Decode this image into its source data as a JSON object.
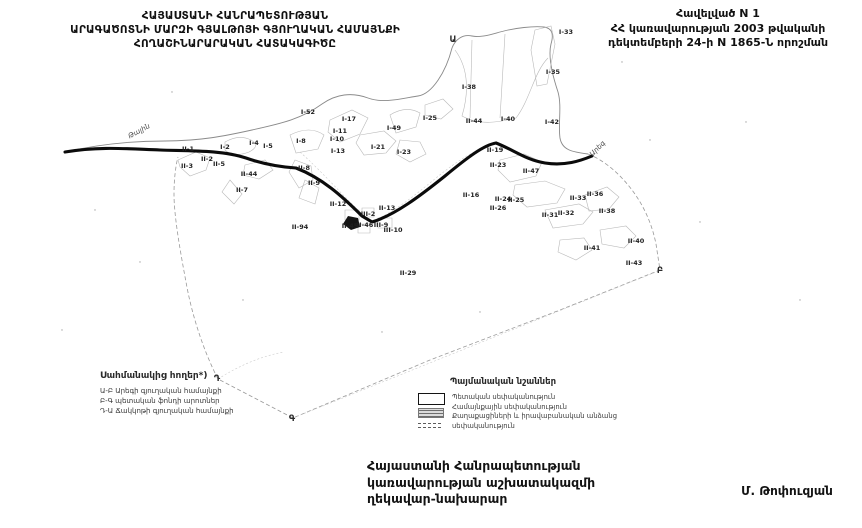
{
  "header": {
    "title_left": [
      "ՀԱՅԱՍՏԱՆԻ ՀԱՆՐԱՊԵՏՈՒԹՅԱՆ",
      "ԱՐԱԳԱԾՈՏՆԻ ՄԱՐԶԻ ԳՅԱԼԹՈՅԻ ԳՅՈՒՂԱԿԱՆ ՀԱՄԱՅՆՔԻ",
      "ՀՈՂԱՇԻՆԱՐԱՐԱԿԱՆ ՀԱՏԱԿԱԳԻԾԸ"
    ],
    "title_right": [
      "Հավելված N 1",
      "ՀՀ կառավարության 2003 թվականի",
      "դեկտեմբերի 24-ի N 1865-Ն որոշման"
    ]
  },
  "map": {
    "parcel_labels": [
      {
        "text": "II-1",
        "x": 188,
        "y": 151
      },
      {
        "text": "I-2",
        "x": 225,
        "y": 149
      },
      {
        "text": "II-2",
        "x": 207,
        "y": 161
      },
      {
        "text": "II-5",
        "x": 219,
        "y": 166
      },
      {
        "text": "II-3",
        "x": 187,
        "y": 168
      },
      {
        "text": "I-4",
        "x": 254,
        "y": 145
      },
      {
        "text": "I-5",
        "x": 268,
        "y": 148
      },
      {
        "text": "II-44",
        "x": 249,
        "y": 176
      },
      {
        "text": "II-7",
        "x": 242,
        "y": 192
      },
      {
        "text": "I-8",
        "x": 301,
        "y": 143
      },
      {
        "text": "II-8",
        "x": 304,
        "y": 170
      },
      {
        "text": "II-9",
        "x": 314,
        "y": 185
      },
      {
        "text": "I-52",
        "x": 308,
        "y": 114
      },
      {
        "text": "I-17",
        "x": 349,
        "y": 121
      },
      {
        "text": "I-11",
        "x": 340,
        "y": 133
      },
      {
        "text": "I-10",
        "x": 337,
        "y": 141
      },
      {
        "text": "I-13",
        "x": 338,
        "y": 153
      },
      {
        "text": "I-49",
        "x": 394,
        "y": 130
      },
      {
        "text": "I-21",
        "x": 378,
        "y": 149
      },
      {
        "text": "I-23",
        "x": 404,
        "y": 154
      },
      {
        "text": "I-25",
        "x": 430,
        "y": 120
      },
      {
        "text": "I-33",
        "x": 566,
        "y": 34
      },
      {
        "text": "I-35",
        "x": 553,
        "y": 74
      },
      {
        "text": "I-38",
        "x": 469,
        "y": 89
      },
      {
        "text": "II-44",
        "x": 474,
        "y": 123
      },
      {
        "text": "I-40",
        "x": 508,
        "y": 121
      },
      {
        "text": "I-42",
        "x": 552,
        "y": 124
      },
      {
        "text": "II-19",
        "x": 495,
        "y": 152
      },
      {
        "text": "II-23",
        "x": 498,
        "y": 167
      },
      {
        "text": "II-47",
        "x": 531,
        "y": 173
      },
      {
        "text": "II-16",
        "x": 471,
        "y": 197
      },
      {
        "text": "II-24",
        "x": 503,
        "y": 201
      },
      {
        "text": "II-25",
        "x": 516,
        "y": 202
      },
      {
        "text": "II-26",
        "x": 498,
        "y": 210
      },
      {
        "text": "II-33",
        "x": 578,
        "y": 200
      },
      {
        "text": "II-36",
        "x": 595,
        "y": 196
      },
      {
        "text": "II-31",
        "x": 550,
        "y": 217
      },
      {
        "text": "II-32",
        "x": 566,
        "y": 215
      },
      {
        "text": "II-38",
        "x": 607,
        "y": 213
      },
      {
        "text": "II-41",
        "x": 592,
        "y": 250
      },
      {
        "text": "II-40",
        "x": 636,
        "y": 243
      },
      {
        "text": "II-43",
        "x": 634,
        "y": 265
      },
      {
        "text": "II-12",
        "x": 338,
        "y": 206
      },
      {
        "text": "II-94",
        "x": 300,
        "y": 229
      },
      {
        "text": "II-45",
        "x": 350,
        "y": 228
      },
      {
        "text": "II-46",
        "x": 365,
        "y": 227
      },
      {
        "text": "III-2",
        "x": 368,
        "y": 216
      },
      {
        "text": "II-13",
        "x": 387,
        "y": 210
      },
      {
        "text": "III-9",
        "x": 381,
        "y": 227
      },
      {
        "text": "III-10",
        "x": 393,
        "y": 232
      },
      {
        "text": "II-29",
        "x": 408,
        "y": 275
      }
    ],
    "corner_letters": [
      {
        "text": "Ա",
        "x": 453,
        "y": 42
      },
      {
        "text": "Բ",
        "x": 660,
        "y": 273
      },
      {
        "text": "Գ",
        "x": 292,
        "y": 421
      },
      {
        "text": "Դ",
        "x": 217,
        "y": 381
      }
    ],
    "road_labels": [
      {
        "text": "Թալին",
        "x": 140,
        "y": 133,
        "rotate": -28
      },
      {
        "text": "Արեգ",
        "x": 599,
        "y": 150,
        "rotate": -45
      }
    ]
  },
  "legend_adjacent": {
    "title": "Սահմանակից հողեր*)",
    "items": [
      "Ա-Բ Արեգի գյուղական համայնքի",
      "Բ-Գ պետական ֆոնդի արոտներ",
      "Դ-Ա Ճակկոթի գյուղական համայնքի"
    ]
  },
  "legend_symbols": {
    "title": "Պայմանական նշաններ",
    "items": [
      "Պետական սեփականություն",
      "Համայնքային սեփականություն",
      "Քաղաքացիների և իրավաբանական անձանց սեփականություն"
    ]
  },
  "footer": {
    "lines": [
      "Հայաստանի Հանրապետության",
      "կառավարության աշխատակազմի",
      "ղեկավար-նախարար"
    ],
    "signature": "Մ. Թոփուզյան"
  }
}
